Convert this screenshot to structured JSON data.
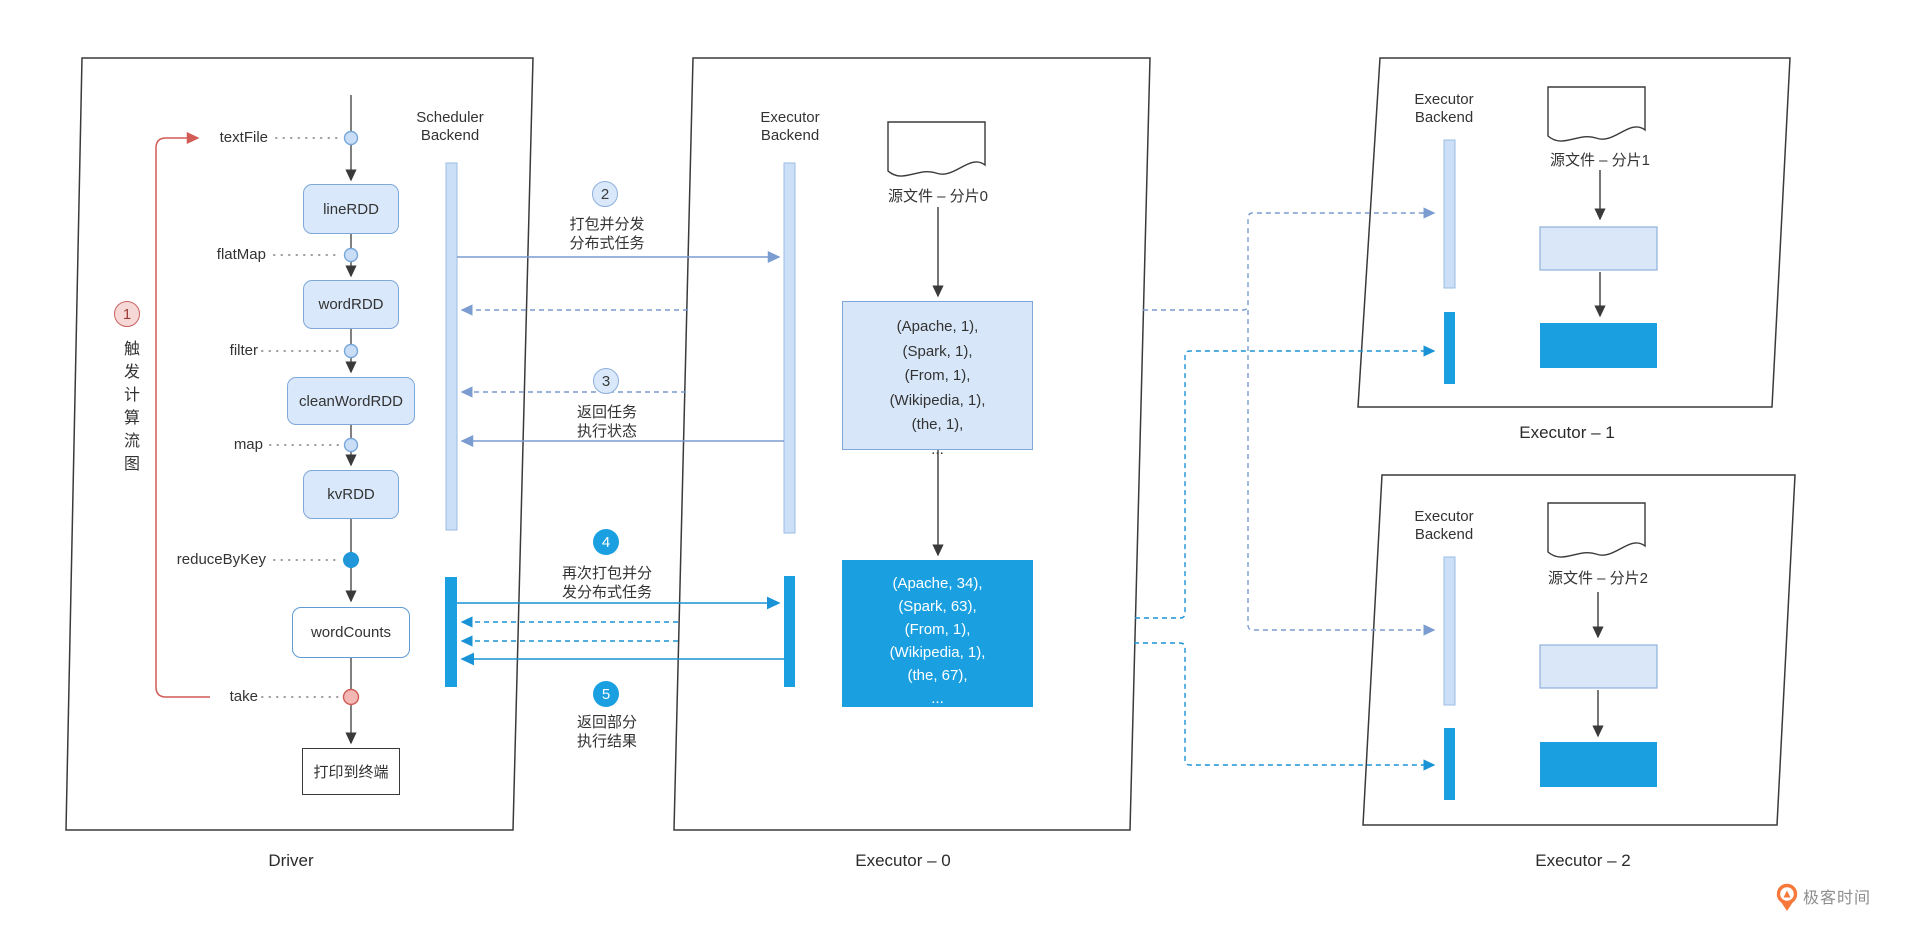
{
  "panels": {
    "driver": {
      "label": "Driver"
    },
    "executor0": {
      "label": "Executor – 0"
    },
    "executor1": {
      "label": "Executor – 1"
    },
    "executor2": {
      "label": "Executor – 2"
    }
  },
  "driver": {
    "step1": {
      "num": "1",
      "caption": "触发计算流图"
    },
    "operators": {
      "textFile": "textFile",
      "flatMap": "flatMap",
      "filter": "filter",
      "map": "map",
      "reduceByKey": "reduceByKey",
      "take": "take"
    },
    "rdds": {
      "lineRDD": "lineRDD",
      "wordRDD": "wordRDD",
      "cleanWordRDD": "cleanWordRDD",
      "kvRDD": "kvRDD",
      "wordCounts": "wordCounts"
    },
    "terminal": "打印到终端",
    "scheduler_backend": {
      "line1": "Scheduler",
      "line2": "Backend"
    }
  },
  "steps": {
    "s2": {
      "num": "2",
      "line1": "打包并分发",
      "line2": "分布式任务"
    },
    "s3": {
      "num": "3",
      "line1": "返回任务",
      "line2": "执行状态"
    },
    "s4": {
      "num": "4",
      "line1": "再次打包并分",
      "line2": "发分布式任务"
    },
    "s5": {
      "num": "5",
      "line1": "返回部分",
      "line2": "执行结果"
    }
  },
  "executor0": {
    "backend": {
      "line1": "Executor",
      "line2": "Backend"
    },
    "source_file": "源文件 – 分片0",
    "map_tuples": [
      "(Apache, 1),",
      "(Spark, 1),",
      "(From, 1),",
      "(Wikipedia, 1),",
      "(the, 1),",
      "..."
    ],
    "reduced_tuples": [
      "(Apache, 34),",
      "(Spark, 63),",
      "(From, 1),",
      "(Wikipedia, 1),",
      "(the, 67),",
      "..."
    ]
  },
  "executor1": {
    "backend": {
      "line1": "Executor",
      "line2": "Backend"
    },
    "source_file": "源文件 – 分片1"
  },
  "executor2": {
    "backend": {
      "line1": "Executor",
      "line2": "Backend"
    },
    "source_file": "源文件 – 分片2"
  },
  "watermark": {
    "text": "极客时间"
  },
  "colors": {
    "accent_blue": "#1AA0E1",
    "light_blue_fill": "#D9E8FA",
    "blue_border": "#7FA8D9",
    "muted_arrow": "#7B9CD0",
    "bright_arrow": "#1A93D6",
    "red": "#D25B56",
    "logo_orange": "#F6793B"
  }
}
